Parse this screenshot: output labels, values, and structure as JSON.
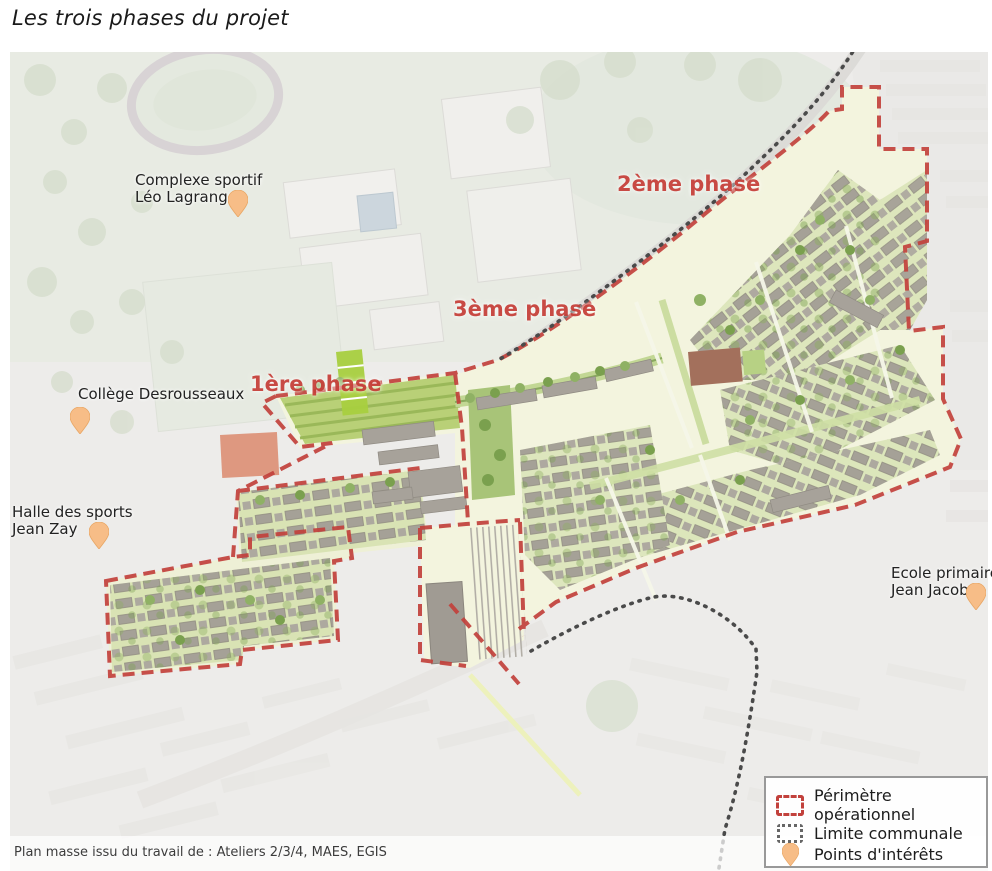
{
  "title": "Les trois phases du projet",
  "map": {
    "phase_labels": [
      {
        "id": "phase-1",
        "text": "1ère phase"
      },
      {
        "id": "phase-2",
        "text": "2ème phase"
      },
      {
        "id": "phase-3",
        "text": "3ème phase"
      }
    ],
    "poi_labels": [
      {
        "id": "complexe-sportif",
        "line1": "Complexe sportif",
        "line2": "Léo Lagrange"
      },
      {
        "id": "college-desrousseaux",
        "line1": "Collège Desrousseaux",
        "line2": ""
      },
      {
        "id": "halle-des-sports",
        "line1": "Halle des sports",
        "line2": "Jean Zay"
      },
      {
        "id": "ecole-primaire",
        "line1": "Ecole primaire",
        "line2": "Jean Jacob"
      }
    ],
    "source": "Plan masse issu du travail de : Ateliers 2/3/4, MAES, EGIS"
  },
  "legend": {
    "items": [
      {
        "icon": "perimeter-dashed-icon",
        "label": "Périmètre opérationnel"
      },
      {
        "icon": "communal-limit-dotted-icon",
        "label": "Limite communale"
      },
      {
        "icon": "poi-pin-icon",
        "label": "Points d'intérêts"
      }
    ]
  },
  "colors": {
    "perimeter_red": "#c2413c",
    "phase_label_red": "#c7423c",
    "communal_limit_gray": "#4a4a4a",
    "pin_orange": "#f7bd87",
    "masterplan_street": "#f3f4de",
    "esplanade_green": "#b9d077"
  }
}
